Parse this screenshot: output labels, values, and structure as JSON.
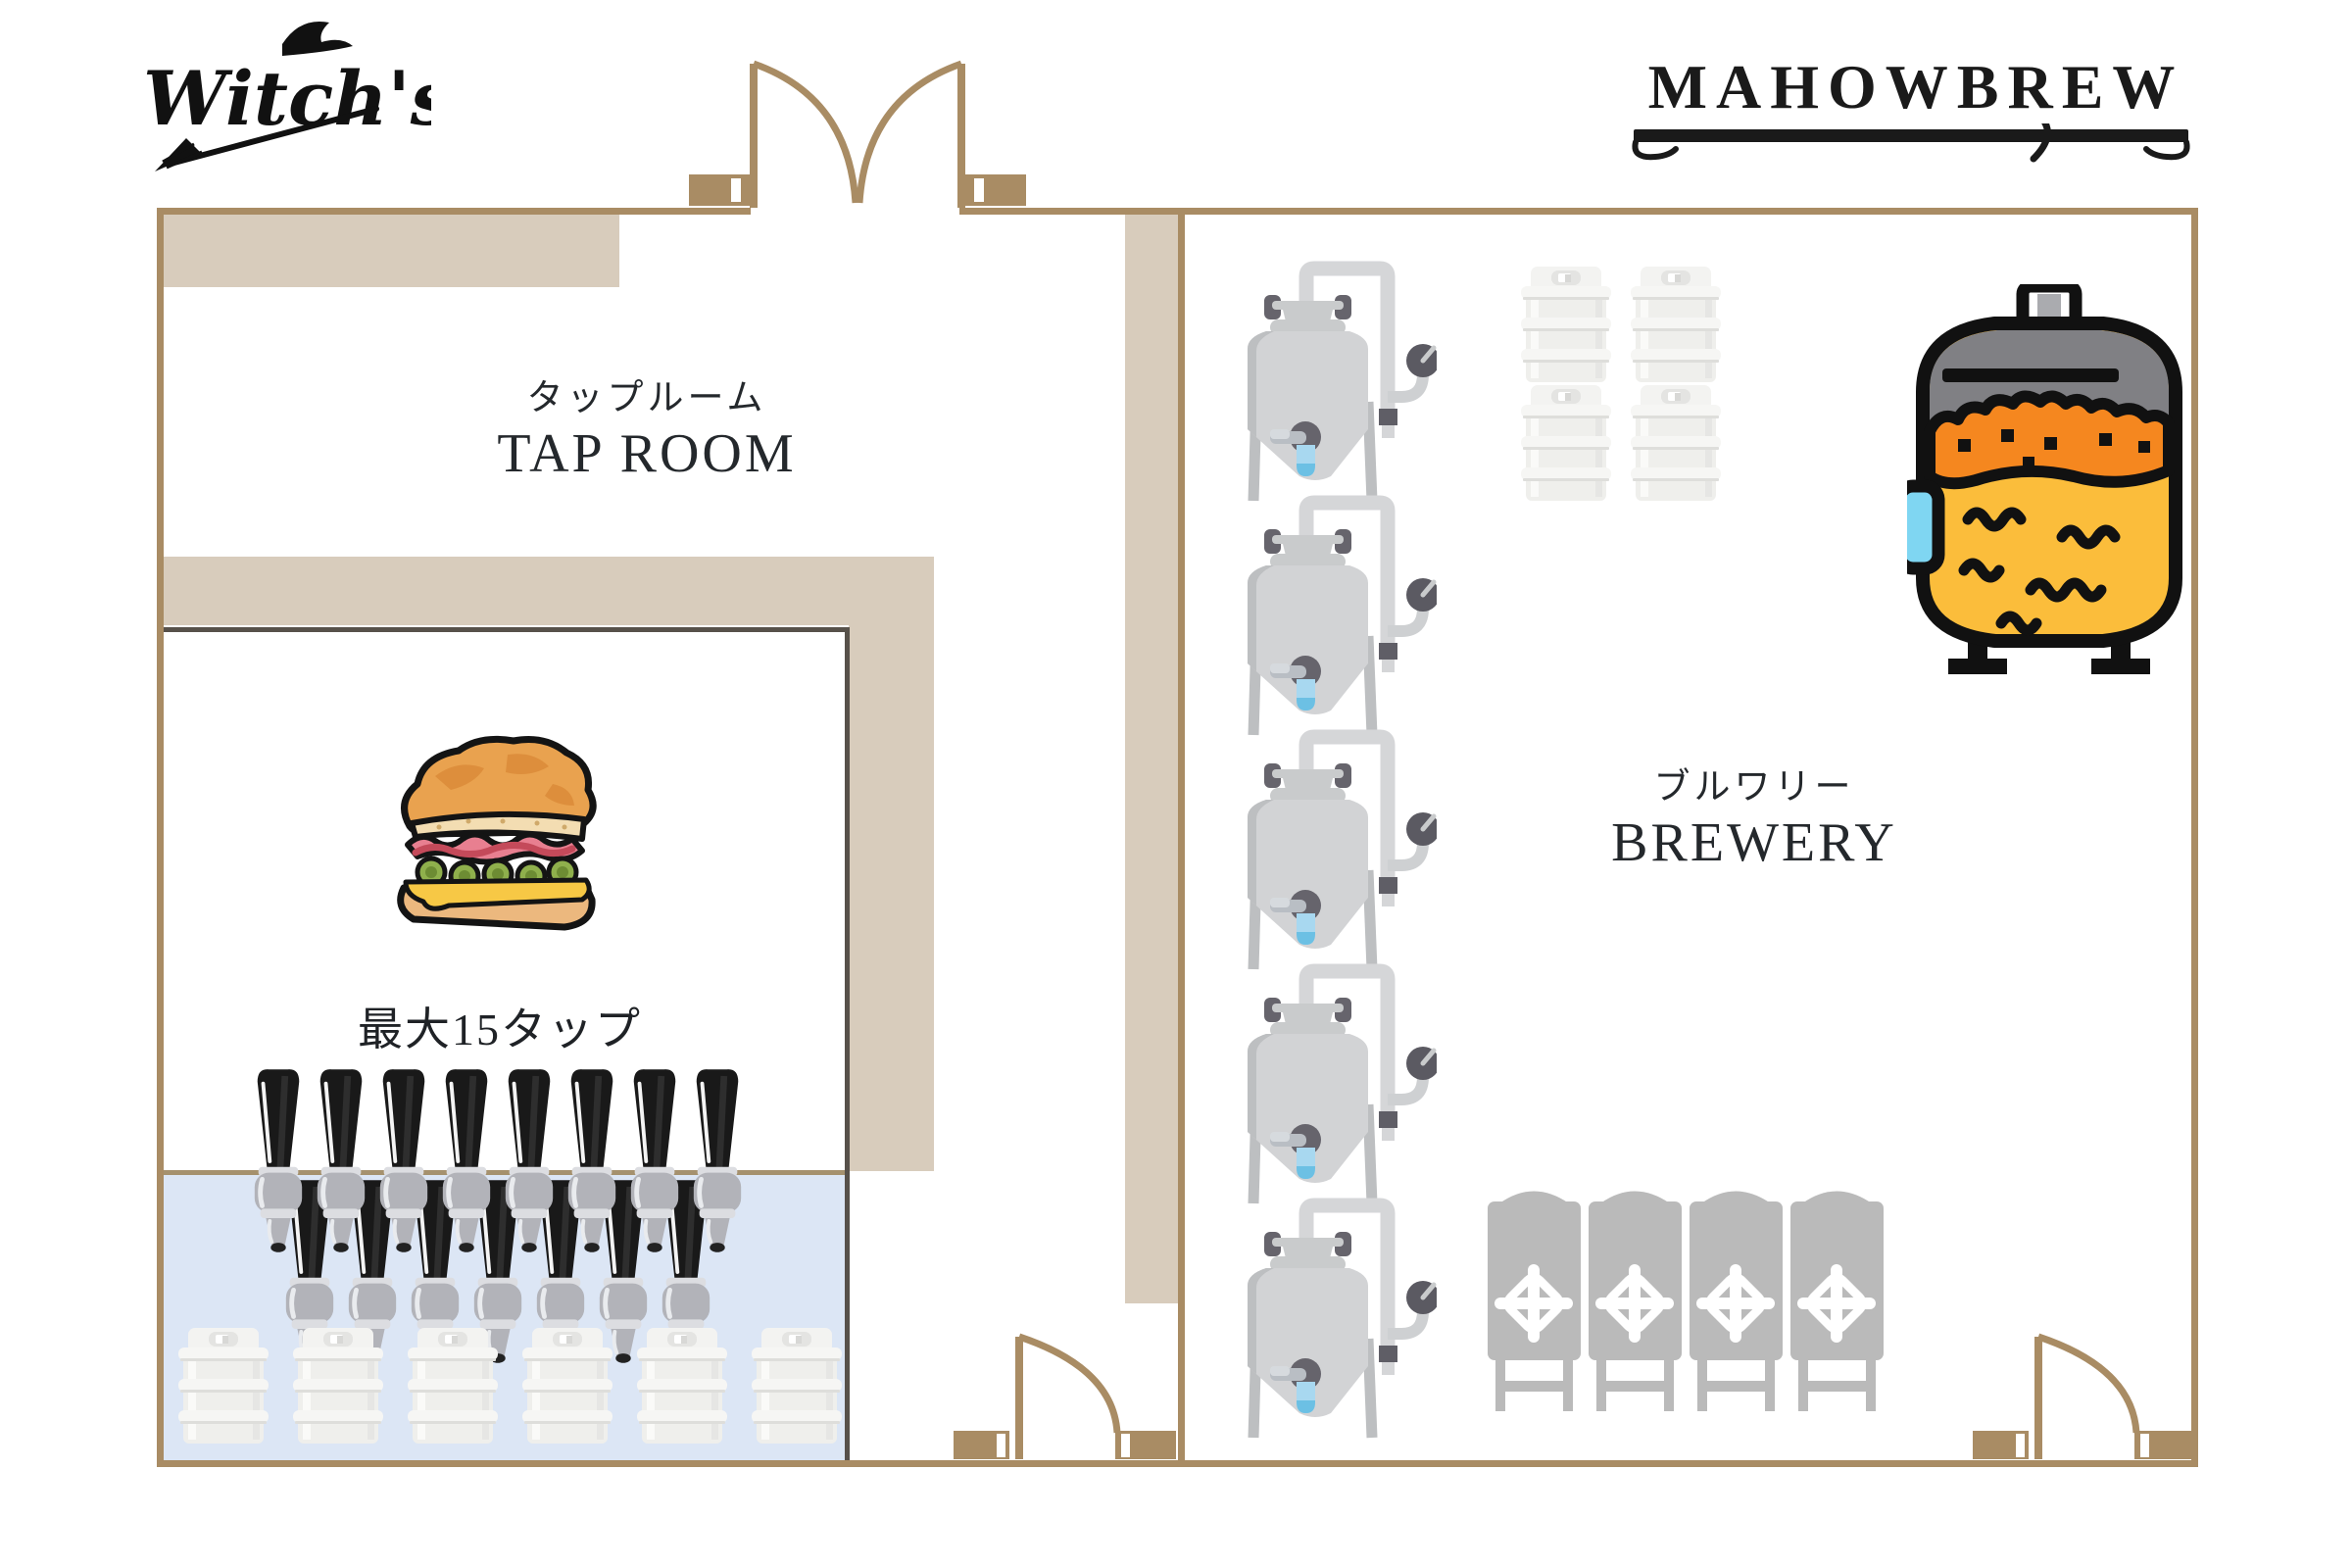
{
  "header": {
    "logo_text": "Witch's",
    "brand_title": "MAHOWBREW"
  },
  "tap_room": {
    "name_jp": "タップルーム",
    "name_en": "TAP ROOM",
    "capacity_note": "最大15タップ",
    "tap_count_back": 8,
    "tap_count_front": 7,
    "keg_count": 6
  },
  "brewery": {
    "name_jp": "ブルワリー",
    "name_en": "BREWERY",
    "fermenter_count": 5,
    "keg_count": 4,
    "brite_tank_count": 4
  },
  "doors": {
    "entrance": "double-swing",
    "tap_room_exit": "single-swing",
    "brewery_exit": "single-swing"
  },
  "colors": {
    "wall": "#a98c64",
    "wall_light": "#d8ccbc",
    "inner_border": "#57514a",
    "bar_counter": "#dce6f5",
    "accent_black": "#1a1a1a",
    "tank_gray": "#d2d3d5",
    "brite_gray": "#bababa",
    "beer_yellow": "#fbbd3b",
    "foam_orange": "#f5871f",
    "valve_blue": "#a8d8f0"
  }
}
